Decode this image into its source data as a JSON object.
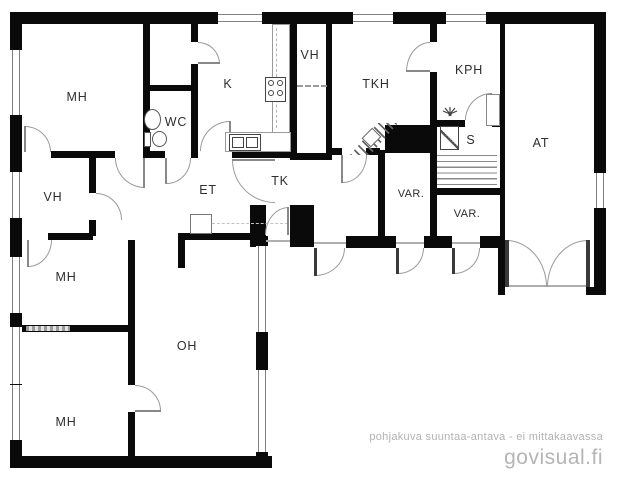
{
  "plan": {
    "title": "floor-plan",
    "rooms": [
      {
        "id": "mh-1",
        "label": "MH"
      },
      {
        "id": "vh-1",
        "label": "VH"
      },
      {
        "id": "mh-2",
        "label": "MH"
      },
      {
        "id": "mh-3",
        "label": "MH"
      },
      {
        "id": "oh",
        "label": "OH"
      },
      {
        "id": "et",
        "label": "ET"
      },
      {
        "id": "wc",
        "label": "WC"
      },
      {
        "id": "k",
        "label": "K"
      },
      {
        "id": "vh-2",
        "label": "VH"
      },
      {
        "id": "tk",
        "label": "TK"
      },
      {
        "id": "tkh",
        "label": "TKH"
      },
      {
        "id": "kph",
        "label": "KPH"
      },
      {
        "id": "s",
        "label": "S"
      },
      {
        "id": "var-1",
        "label": "VAR."
      },
      {
        "id": "var-2",
        "label": "VAR."
      },
      {
        "id": "at",
        "label": "AT"
      }
    ],
    "icons": [
      "toilet-icon",
      "wc-sink-icon",
      "stove-icon",
      "kitchen-sink-icon",
      "shower-icon",
      "sauna-stove-icon",
      "fireplace-icon",
      "sauna-benches",
      "water-heater",
      "hall-cabinet"
    ],
    "colors": {
      "wall": "#0a0a0a",
      "door_arc": "#9a9a9a",
      "window_line": "#808080",
      "label": "#2e2e2e",
      "footer": "#b2b2b2"
    }
  },
  "footer": {
    "disclaimer": "pohjakuva suuntaa-antava - ei mittakaavassa",
    "brand": "govisual.fi"
  }
}
